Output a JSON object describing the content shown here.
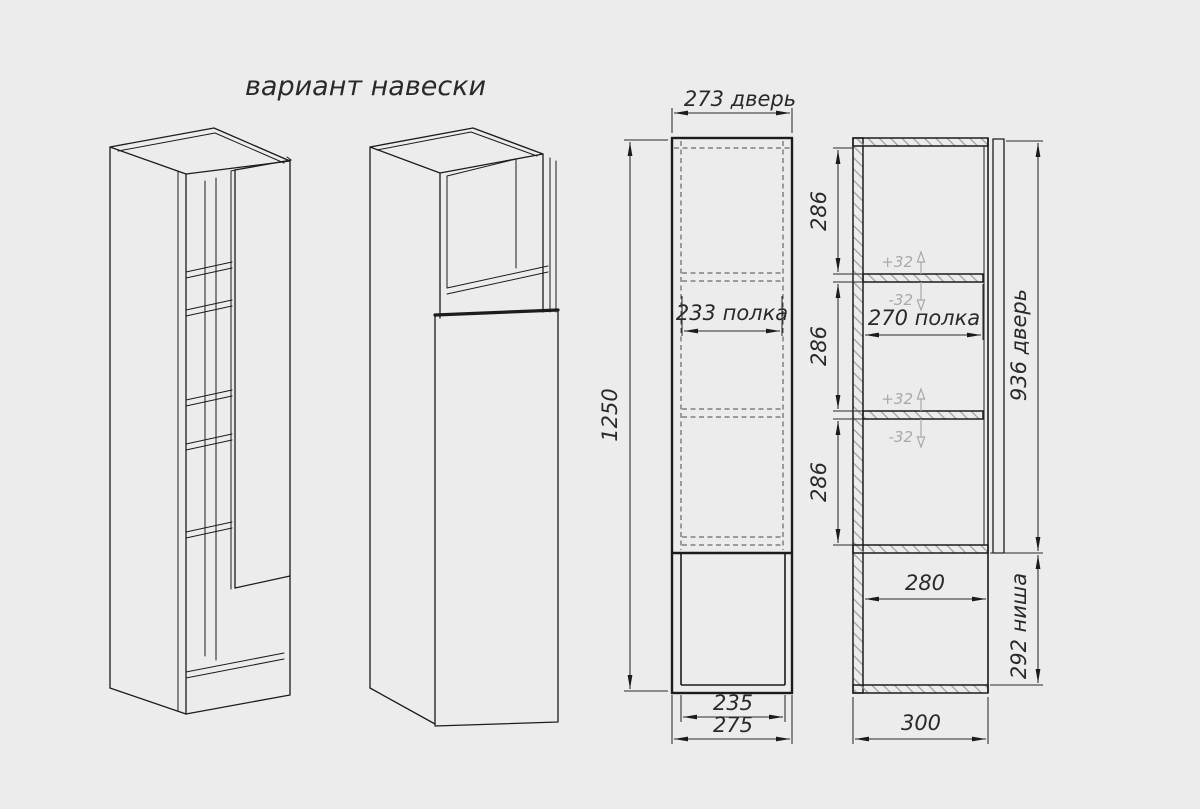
{
  "title": "вариант навески",
  "colors": {
    "background": "#ececec",
    "line": "#1c1c1c",
    "hatch": "#9b9b9b",
    "adjust_annotation": "#a9a9a9"
  },
  "front_view": {
    "door_width_label": "273 дверь",
    "shelf_label": "233 полка",
    "overall_height": "1250",
    "niche_inner_width": "235",
    "overall_width": "275"
  },
  "section_view": {
    "spacing_top": "286",
    "spacing_middle": "286",
    "spacing_bottom": "286",
    "shelf_up_adjust": "+32",
    "shelf_down_adjust": "-32",
    "shelf_label": "270 полка",
    "door_height_label": "936 дверь",
    "niche_depth": "280",
    "niche_height_label": "292 ниша",
    "overall_depth": "300"
  }
}
